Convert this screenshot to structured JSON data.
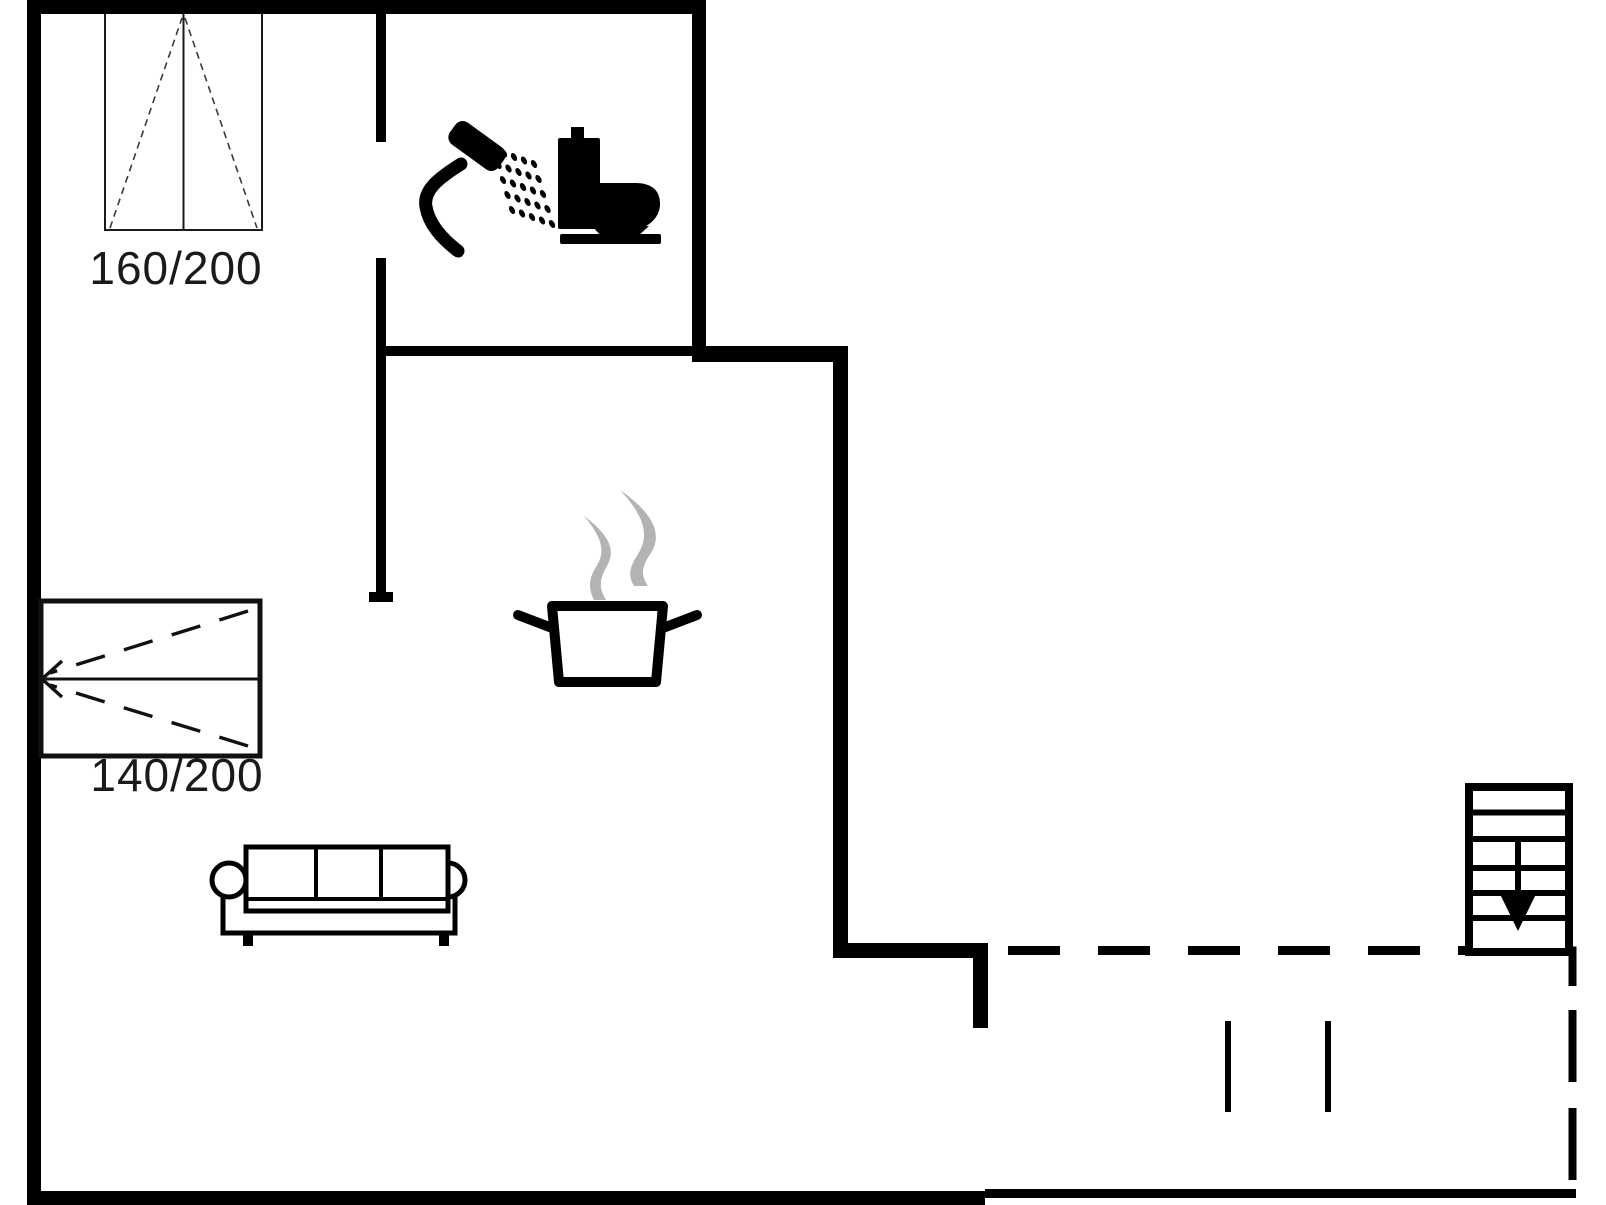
{
  "page": {
    "type": "floor-plan-drawing",
    "background": "#ffffff"
  },
  "labels": {
    "window_size": "160/200",
    "door_size": "140/200"
  },
  "colors": {
    "wall": "#000000",
    "symbol_line": "#1a1a1a",
    "steam": "#b3b3b3",
    "text": "#1a1a1a"
  },
  "icons": [
    "window-symbol",
    "double-door-symbol",
    "shower-icon",
    "toilet-icon",
    "steam-icon",
    "cooking-pot-icon",
    "sofa-icon",
    "stairs-icon",
    "stairs-down-arrow-icon",
    "terrace-dashed-boundary",
    "terrace-posts"
  ]
}
